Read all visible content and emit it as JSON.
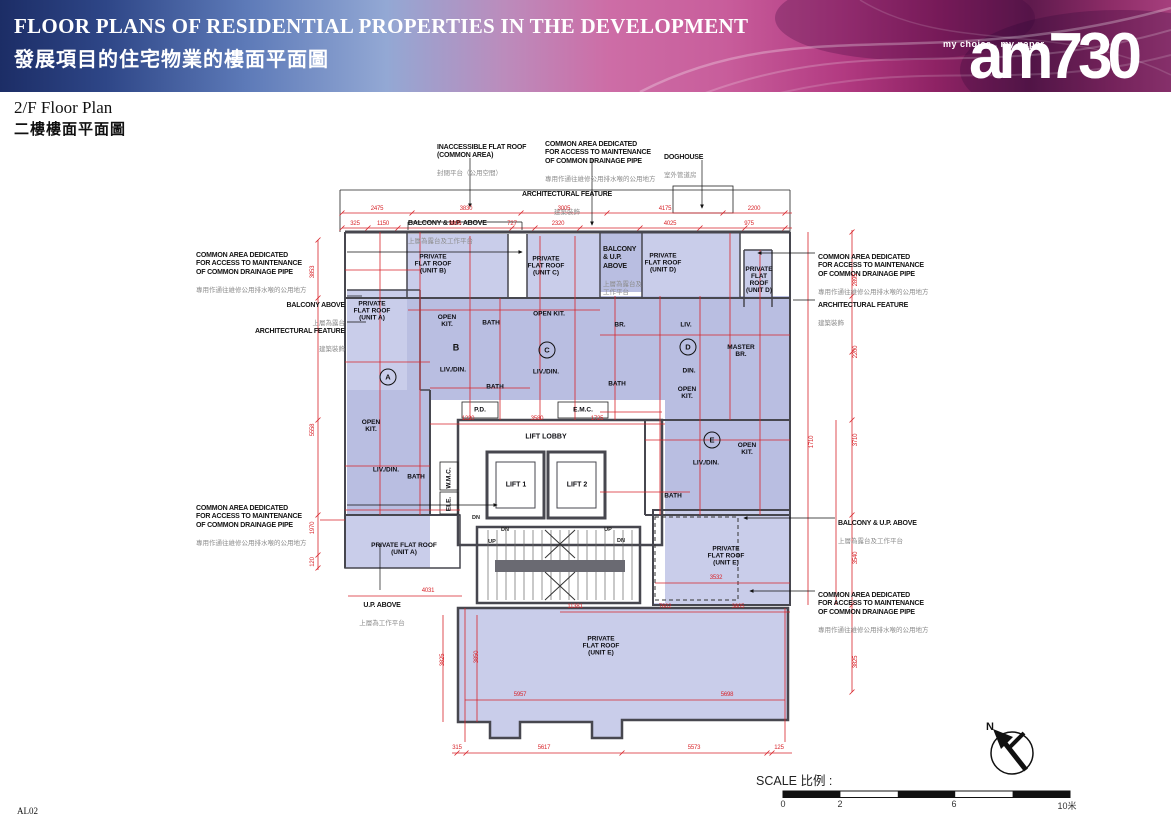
{
  "header": {
    "title_en": "FLOOR PLANS OF RESIDENTIAL PROPERTIES IN THE DEVELOPMENT",
    "title_zh": "發展項目的住宅物業的樓面平面圖",
    "logo_tagline": "my choice . my paper",
    "logo_name": "am730"
  },
  "subtitle": {
    "en": "2/F Floor Plan",
    "zh": "二樓樓面平面圖"
  },
  "colors": {
    "dimension_red": "#d8252b",
    "wall_gray": "#47474f",
    "unit_fill": "#b9bee1",
    "roof_fill": "#c9cdea"
  },
  "plan": {
    "callouts": [
      {
        "en": "INACCESSIBLE FLAT ROOF\n(COMMON AREA)",
        "zh": "封閉平台（公用空間）",
        "x": 437,
        "y": 135
      },
      {
        "en": "COMMON AREA DEDICATED\nFOR ACCESS TO MAINTENANCE\nOF COMMON DRAINAGE PIPE",
        "zh": "專用作通往維修公用排水喉的公用地方",
        "x": 545,
        "y": 132
      },
      {
        "en": "DOGHOUSE",
        "zh": "室外管道房",
        "x": 664,
        "y": 145
      },
      {
        "en": "ARCHITECTURAL FEATURE",
        "zh": "建築裝飾",
        "x": 567,
        "y": 182,
        "cls": "align-center"
      },
      {
        "en": "BALCONY & U.P. ABOVE",
        "zh": "上層為露台及工作平台",
        "x": 408,
        "y": 211
      },
      {
        "en": "COMMON AREA DEDICATED\nFOR ACCESS TO MAINTENANCE\nOF COMMON DRAINAGE PIPE",
        "zh": "專用作通往維修公用排水喉的公用地方",
        "x": 196,
        "y": 243
      },
      {
        "en": "BALCONY ABOVE",
        "zh": "上層為露台",
        "x": 345,
        "y": 293,
        "cls": "align-right"
      },
      {
        "en": "ARCHITECTURAL FEATURE",
        "zh": "建築裝飾",
        "x": 345,
        "y": 319,
        "cls": "align-right"
      },
      {
        "en": "COMMON AREA DEDICATED\nFOR ACCESS TO MAINTENANCE\nOF COMMON DRAINAGE PIPE",
        "zh": "專用作通往維修公用排水喉的公用地方",
        "x": 196,
        "y": 496
      },
      {
        "en": "U.P. ABOVE",
        "zh": "上層為工作平台",
        "x": 382,
        "y": 593,
        "cls": "align-center"
      },
      {
        "en": "COMMON AREA DEDICATED\nFOR ACCESS TO MAINTENANCE\nOF COMMON DRAINAGE PIPE",
        "zh": "專用作通往維修公用排水喉的公用地方",
        "x": 818,
        "y": 245
      },
      {
        "en": "ARCHITECTURAL FEATURE",
        "zh": "建築裝飾",
        "x": 818,
        "y": 293
      },
      {
        "en": "BALCONY & U.P. ABOVE",
        "zh": "上層為露台及工作平台",
        "x": 838,
        "y": 511
      },
      {
        "en": "COMMON AREA DEDICATED\nFOR ACCESS TO MAINTENANCE\nOF COMMON DRAINAGE PIPE",
        "zh": "專用作通往維修公用排水喉的公用地方",
        "x": 818,
        "y": 583
      },
      {
        "en": "BALCONY\n& U.P.\nABOVE",
        "zh": "上層為露台及\n工作平台",
        "x": 603,
        "y": 237
      }
    ],
    "room_labels": [
      {
        "t": "PRIVATE\nFLAT ROOF\n(UNIT B)",
        "x": 433,
        "y": 264
      },
      {
        "t": "PRIVATE\nFLAT ROOF\n(UNIT C)",
        "x": 546,
        "y": 266
      },
      {
        "t": "PRIVATE\nFLAT ROOF\n(UNIT D)",
        "x": 663,
        "y": 263
      },
      {
        "t": "PRIVATE\nFLAT\nROOF\n(UNIT D)",
        "x": 759,
        "y": 280
      },
      {
        "t": "PRIVATE\nFLAT ROOF\n(UNIT A)",
        "x": 372,
        "y": 311
      },
      {
        "t": "OPEN\nKIT.",
        "x": 447,
        "y": 321
      },
      {
        "t": "BATH",
        "x": 491,
        "y": 323
      },
      {
        "t": "OPEN KIT.",
        "x": 549,
        "y": 314
      },
      {
        "t": "BR.",
        "x": 620,
        "y": 325
      },
      {
        "t": "LIV.",
        "x": 686,
        "y": 325
      },
      {
        "t": "MASTER\nBR.",
        "x": 741,
        "y": 351
      },
      {
        "t": "LIV./DIN.",
        "x": 453,
        "y": 370
      },
      {
        "t": "LIV./DIN.",
        "x": 546,
        "y": 372
      },
      {
        "t": "BATH",
        "x": 495,
        "y": 387
      },
      {
        "t": "BATH",
        "x": 617,
        "y": 384
      },
      {
        "t": "DIN.",
        "x": 689,
        "y": 371
      },
      {
        "t": "OPEN\nKIT.",
        "x": 687,
        "y": 393
      },
      {
        "t": "P.D.",
        "x": 480,
        "y": 410
      },
      {
        "t": "E.M.C.",
        "x": 583,
        "y": 410
      },
      {
        "t": "LIFT LOBBY",
        "x": 546,
        "y": 437,
        "cls": "big"
      },
      {
        "t": "LIFT 1",
        "x": 516,
        "y": 485,
        "cls": "big"
      },
      {
        "t": "LIFT 2",
        "x": 577,
        "y": 485,
        "cls": "big"
      },
      {
        "t": "W.M.C.",
        "x": 449,
        "y": 478,
        "cls": "v"
      },
      {
        "t": "ELE.",
        "x": 449,
        "y": 504,
        "cls": "v"
      },
      {
        "t": "OPEN\nKIT.",
        "x": 371,
        "y": 426
      },
      {
        "t": "LIV./DIN.",
        "x": 386,
        "y": 470
      },
      {
        "t": "BATH",
        "x": 416,
        "y": 477
      },
      {
        "t": "LIV./DIN.",
        "x": 706,
        "y": 463
      },
      {
        "t": "OPEN\nKIT.",
        "x": 747,
        "y": 449
      },
      {
        "t": "BATH",
        "x": 673,
        "y": 496
      },
      {
        "t": "PRIVATE FLAT ROOF\n(UNIT A)",
        "x": 404,
        "y": 549
      },
      {
        "t": "PRIVATE\nFLAT ROOF\n(UNIT E)",
        "x": 726,
        "y": 556
      },
      {
        "t": "PRIVATE\nFLAT ROOF\n(UNIT E)",
        "x": 601,
        "y": 646
      }
    ],
    "unit_marks": [
      {
        "t": "A",
        "x": 388,
        "y": 377
      },
      {
        "t": "B",
        "x": 456,
        "y": 347,
        "cls": "plain"
      },
      {
        "t": "C",
        "x": 547,
        "y": 350
      },
      {
        "t": "D",
        "x": 688,
        "y": 347
      },
      {
        "t": "E",
        "x": 712,
        "y": 440
      }
    ],
    "stair_labels": [
      {
        "t": "DN",
        "x": 476,
        "y": 518
      },
      {
        "t": "DN",
        "x": 505,
        "y": 530
      },
      {
        "t": "UP",
        "x": 608,
        "y": 530
      },
      {
        "t": "DN",
        "x": 621,
        "y": 541
      },
      {
        "t": "UP",
        "x": 492,
        "y": 542
      }
    ],
    "dimensions": [
      {
        "t": "2475",
        "x": 377,
        "y": 212
      },
      {
        "t": "3830",
        "x": 466,
        "y": 212
      },
      {
        "t": "3005",
        "x": 564,
        "y": 212
      },
      {
        "t": "4175",
        "x": 665,
        "y": 212
      },
      {
        "t": "2200",
        "x": 754,
        "y": 212
      },
      {
        "t": "325",
        "x": 355,
        "y": 227
      },
      {
        "t": "1150",
        "x": 383,
        "y": 227
      },
      {
        "t": "3805",
        "x": 455,
        "y": 227
      },
      {
        "t": "727",
        "x": 512,
        "y": 227
      },
      {
        "t": "2320",
        "x": 558,
        "y": 227
      },
      {
        "t": "4025",
        "x": 670,
        "y": 227
      },
      {
        "t": "975",
        "x": 749,
        "y": 227
      },
      {
        "t": "3853",
        "x": 313,
        "y": 272,
        "cls": "v"
      },
      {
        "t": "5558",
        "x": 313,
        "y": 430,
        "cls": "v"
      },
      {
        "t": "1970",
        "x": 313,
        "y": 528,
        "cls": "v"
      },
      {
        "t": "120",
        "x": 313,
        "y": 562,
        "cls": "v"
      },
      {
        "t": "2895",
        "x": 856,
        "y": 280,
        "cls": "v"
      },
      {
        "t": "2200",
        "x": 856,
        "y": 352,
        "cls": "v"
      },
      {
        "t": "3710",
        "x": 856,
        "y": 440,
        "cls": "v"
      },
      {
        "t": "3540",
        "x": 856,
        "y": 558,
        "cls": "v"
      },
      {
        "t": "3825",
        "x": 856,
        "y": 662,
        "cls": "v"
      },
      {
        "t": "1710",
        "x": 812,
        "y": 442,
        "cls": "v"
      },
      {
        "t": "315",
        "x": 457,
        "y": 751
      },
      {
        "t": "5617",
        "x": 544,
        "y": 751
      },
      {
        "t": "5573",
        "x": 694,
        "y": 751
      },
      {
        "t": "125",
        "x": 779,
        "y": 751
      },
      {
        "t": "11381",
        "x": 575,
        "y": 610
      },
      {
        "t": "7602",
        "x": 665,
        "y": 610
      },
      {
        "t": "3805",
        "x": 738,
        "y": 610
      },
      {
        "t": "5957",
        "x": 520,
        "y": 698
      },
      {
        "t": "5698",
        "x": 727,
        "y": 698
      },
      {
        "t": "3825",
        "x": 443,
        "y": 660,
        "cls": "v"
      },
      {
        "t": "3850",
        "x": 477,
        "y": 657,
        "cls": "v"
      },
      {
        "t": "1220",
        "x": 468,
        "y": 422
      },
      {
        "t": "3580",
        "x": 537,
        "y": 422
      },
      {
        "t": "1725",
        "x": 597,
        "y": 422
      },
      {
        "t": "4031",
        "x": 428,
        "y": 594
      },
      {
        "t": "3532",
        "x": 716,
        "y": 581
      }
    ]
  },
  "scale": {
    "label": "SCALE 比例 :",
    "ticks": [
      {
        "t": "0",
        "x": 783
      },
      {
        "t": "2",
        "x": 840
      },
      {
        "t": "6",
        "x": 954
      },
      {
        "t": "10米",
        "x": 1067
      }
    ]
  },
  "north": {
    "label": "N"
  },
  "footer": {
    "code": "AL02"
  }
}
